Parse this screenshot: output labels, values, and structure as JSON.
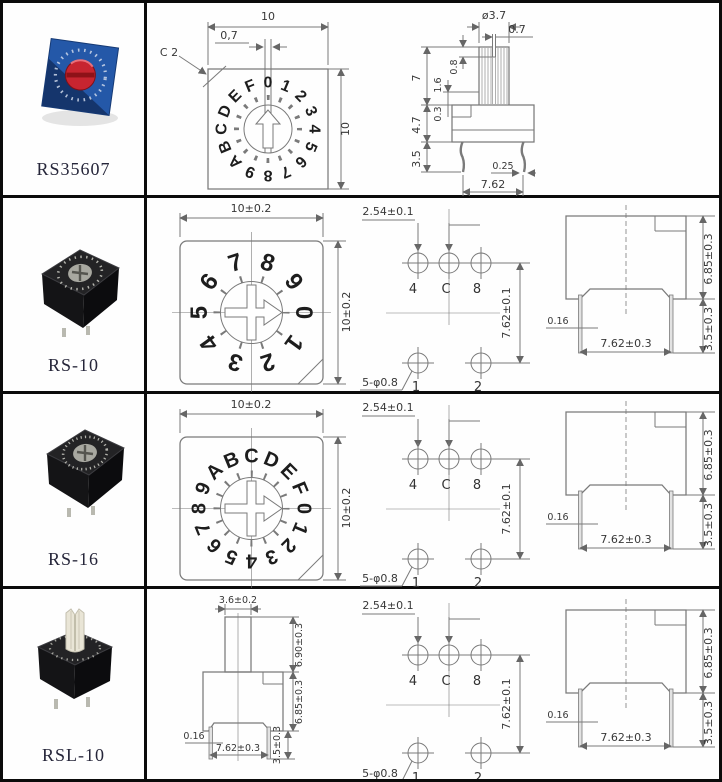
{
  "palette": {
    "table_border": "#0b0b0b",
    "drawing_line": "#7a7a7a",
    "dimension_text": "#383838",
    "dial_char": "#1d1d1d",
    "label_text": "#26263a",
    "photo_blue_body": "#2458a8",
    "photo_red_knob": "#c72530",
    "photo_black_body": "#1b1b1d",
    "photo_rotor_gray": "#a8a8a0",
    "photo_shaft_ivory": "#e9e5d6"
  },
  "rows": [
    {
      "model": "RS35607",
      "front": {
        "width_dim": "10",
        "height_dim": "10",
        "slot_dim": "0,7",
        "chamfer_label": "C 2",
        "chars": [
          "0",
          "1",
          "2",
          "3",
          "4",
          "5",
          "6",
          "7",
          "8",
          "9",
          "A",
          "B",
          "C",
          "D",
          "E",
          "F"
        ]
      },
      "side": {
        "shaft_dia": "ø3.7",
        "slot_width": "0.7",
        "slot_depth": "0.8",
        "shaft_height": "7",
        "step_offset": "1.6",
        "body_height": "4.7",
        "step_depth": "0.3",
        "pin_length": "3.5",
        "pin_width": "0.25",
        "pin_pitch": "7.62"
      }
    },
    {
      "model": "RS-10",
      "front": {
        "width_dim": "10±0.2",
        "height_dim": "10±0.2",
        "chars": [
          "0",
          "1",
          "2",
          "3",
          "4",
          "5",
          "6",
          "7",
          "8",
          "9"
        ]
      },
      "pins": {
        "pitch_x": "2.54±0.1",
        "pitch_y": "7.62±0.1",
        "hole_note": "5-φ0.8",
        "top_labels": [
          "4",
          "C",
          "8"
        ],
        "bottom_labels": [
          "1",
          "2"
        ]
      },
      "side": {
        "body_height": "6.85±0.3",
        "pin_width": "0.16",
        "pin_pitch": "7.62±0.3",
        "pin_length": "3.5±0.3"
      }
    },
    {
      "model": "RS-16",
      "front": {
        "width_dim": "10±0.2",
        "height_dim": "10±0.2",
        "chars": [
          "0",
          "1",
          "2",
          "3",
          "4",
          "5",
          "6",
          "7",
          "8",
          "9",
          "A",
          "B",
          "C",
          "D",
          "E",
          "F"
        ]
      },
      "pins": {
        "pitch_x": "2.54±0.1",
        "pitch_y": "7.62±0.1",
        "hole_note": "5-φ0.8",
        "top_labels": [
          "4",
          "C",
          "8"
        ],
        "bottom_labels": [
          "1",
          "2"
        ]
      },
      "side": {
        "body_height": "6.85±0.3",
        "pin_width": "0.16",
        "pin_pitch": "7.62±0.3",
        "pin_length": "3.5±0.3"
      }
    },
    {
      "model": "RSL-10",
      "shaft_view": {
        "shaft_width": "3.6±0.2",
        "shaft_height": "6.90±0.3",
        "body_height": "6.85±0.3",
        "pin_width": "0.16",
        "pin_pitch": "7.62±0.3",
        "pin_length": "3.5±0.3"
      },
      "pins": {
        "pitch_x": "2.54±0.1",
        "pitch_y": "7.62±0.1",
        "hole_note": "5-φ0.8",
        "top_labels": [
          "4",
          "C",
          "8"
        ],
        "bottom_labels": [
          "1",
          "2"
        ]
      },
      "side": {
        "body_height": "6.85±0.3",
        "pin_width": "0.16",
        "pin_pitch": "7.62±0.3",
        "pin_length": "3.5±0.3"
      }
    }
  ]
}
